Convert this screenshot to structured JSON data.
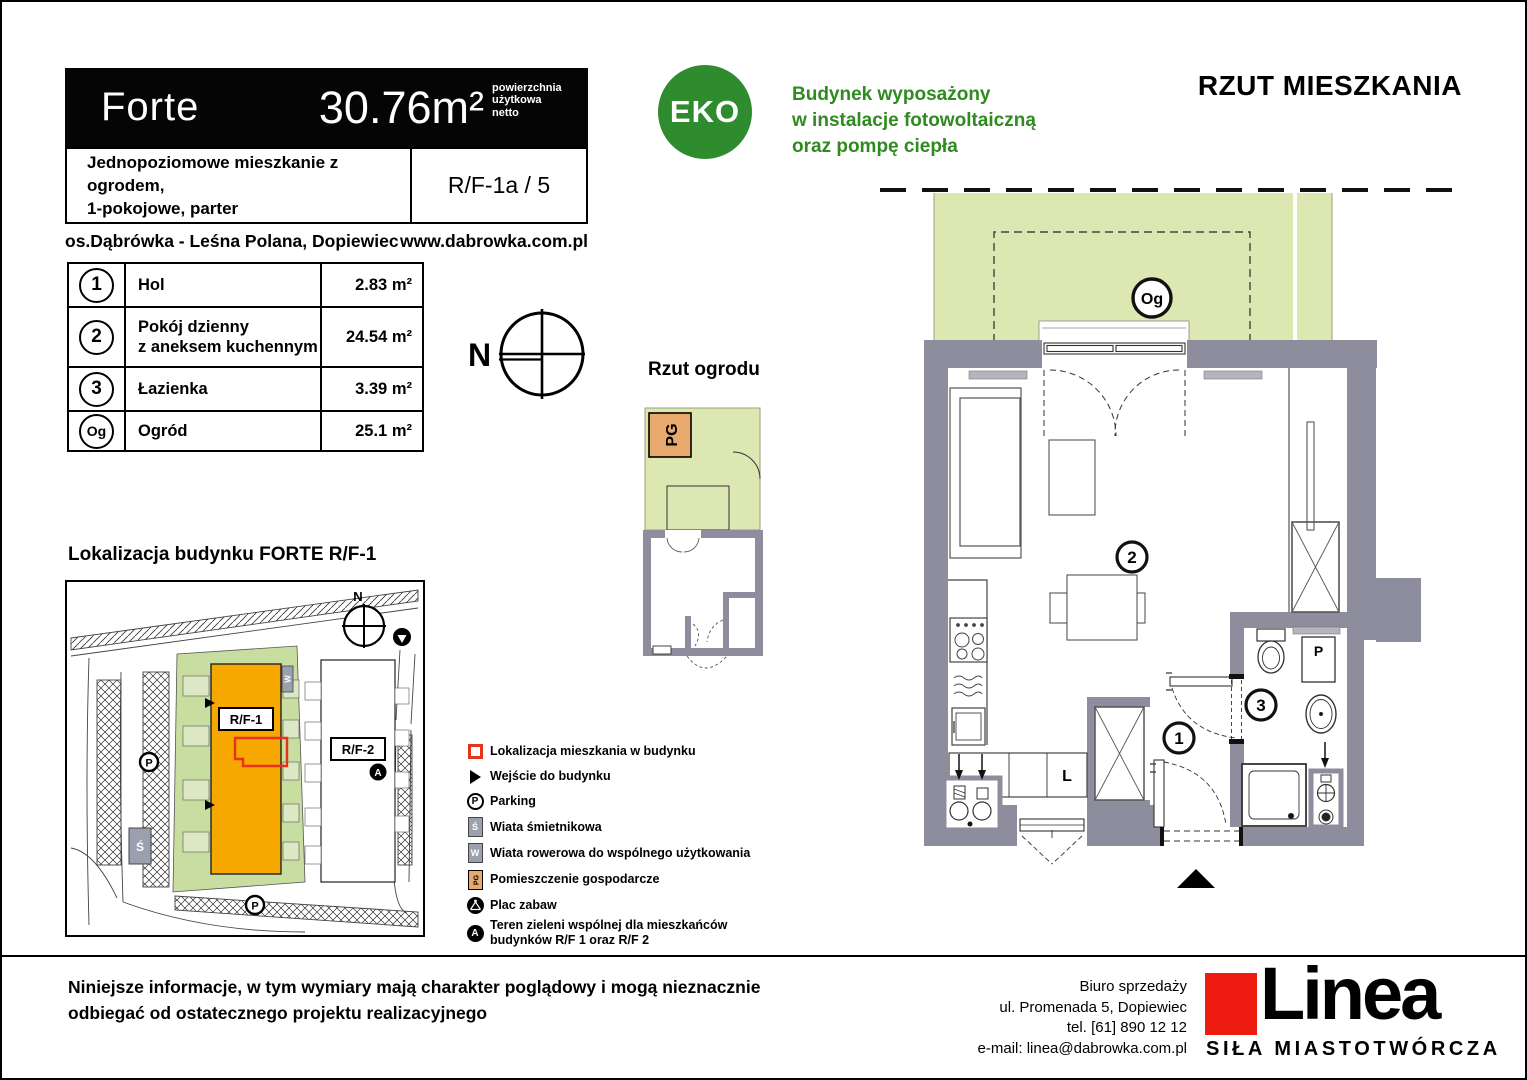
{
  "header": {
    "project_name": "Forte",
    "area_value": "30.76m²",
    "area_note1": "powierzchnia",
    "area_note2": "użytkowa",
    "area_note3": "netto",
    "desc_line1": "Jednopoziomowe mieszkanie z ogrodem,",
    "desc_line2": "1-pokojowe, parter",
    "unit_code": "R/F-1a / 5",
    "estate": "os.Dąbrówka - Leśna Polana, Dopiewiec",
    "website": "www.dabrowka.com.pl"
  },
  "eco": {
    "badge": "EKO",
    "line1": "Budynek wyposażony",
    "line2": "w instalacje fotowoltaiczną",
    "line3": "oraz pompę ciepła"
  },
  "plan_title": "RZUT MIESZKANIA",
  "rooms": {
    "rows": [
      {
        "id": "1",
        "name": "Hol",
        "name2": "",
        "area": "2.83 m²"
      },
      {
        "id": "2",
        "name": "Pokój dzienny",
        "name2": "z aneksem kuchennym",
        "area": "24.54 m²"
      },
      {
        "id": "3",
        "name": "Łazienka",
        "name2": "",
        "area": "3.39 m²"
      },
      {
        "id": "Og",
        "name": "Ogród",
        "name2": "",
        "area": "25.1 m²"
      }
    ]
  },
  "compass": {
    "north": "N"
  },
  "garden_plan": {
    "title": "Rzut ogrodu",
    "pg_label": "PG"
  },
  "site_map": {
    "title": "Lokalizacja budynku  FORTE  R/F-1",
    "building1": "R/F-1",
    "building2": "R/F-2",
    "north": "N",
    "parking": "P",
    "shed": "Ś",
    "bike_shed": "W",
    "green_marker": "A"
  },
  "legend": {
    "items": [
      {
        "label": "Lokalizacja mieszkania w budynku",
        "label2": ""
      },
      {
        "label": "Wejście do budynku",
        "label2": ""
      },
      {
        "label": "Parking",
        "label2": ""
      },
      {
        "label": "Wiata śmietnikowa",
        "label2": ""
      },
      {
        "label": "Wiata rowerowa do wspólnego użytkowania",
        "label2": ""
      },
      {
        "label": "Pomieszczenie gospodarcze",
        "label2": ""
      },
      {
        "label": "Plac zabaw",
        "label2": ""
      },
      {
        "label": "Teren zieleni wspólnej dla mieszkańców",
        "label2": "budynków R/F 1 oraz R/F 2"
      }
    ],
    "icons": {
      "parking": "P",
      "shed": "Ś",
      "bike": "W",
      "pg": "PG",
      "green": "A"
    }
  },
  "floor_plan": {
    "garden_label": "Og",
    "room1": "1",
    "room2": "2",
    "room3": "3",
    "fridge_label": "L",
    "washer_label": "P"
  },
  "footer": {
    "disclaimer1": "Niniejsze informacje, w tym wymiary mają charakter poglądowy i mogą nieznacznie",
    "disclaimer2": "odbiegać od ostatecznego projektu realizacyjnego",
    "office1": "Biuro sprzedaży",
    "office2": "ul. Promenada 5, Dopiewiec",
    "office3": "tel. [61] 890 12 12",
    "office4": "e-mail: linea@dabrowka.com.pl",
    "logo_text": "Linea",
    "logo_tagline": "SIŁA MIASTOTWÓRCZA"
  },
  "colors": {
    "eco_green": "#2e8b2e",
    "text_green": "#2f8b1f",
    "garden_green": "#dce7b2",
    "map_green": "#c8dda0",
    "building_orange": "#f7a800",
    "pg_orange": "#e9a96d",
    "wall_gray": "#8d8d9d",
    "accent_red": "#e8321e",
    "logo_red": "#ee1b10"
  }
}
